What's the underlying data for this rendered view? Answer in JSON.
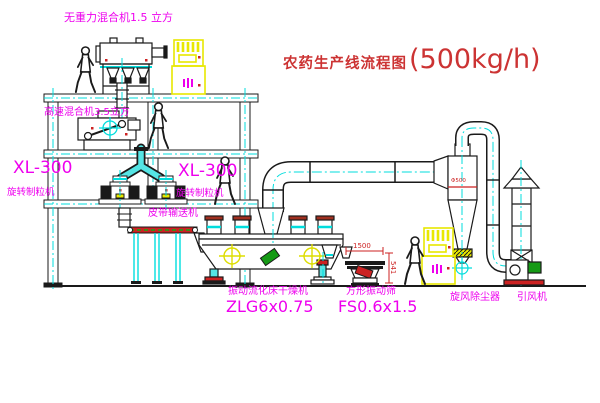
{
  "title": {
    "text": "农药生产线流程图",
    "capacity": "(500kg/h)"
  },
  "equipment": {
    "gravity_mixer": {
      "label": "无重力混合机1.5 立方"
    },
    "high_speed_mixer": {
      "label": "高速混合机3.5立方"
    },
    "granulator_left": {
      "model": "XL-300",
      "label": "旋转制粒机"
    },
    "granulator_right": {
      "model": "XL-300",
      "label": "旋转制粒机"
    },
    "belt_conveyor": {
      "label": "皮带输送机"
    },
    "fluid_bed_dryer": {
      "label": "振动流化床干燥机",
      "model": "ZLG6x0.75"
    },
    "square_sieve": {
      "label": "方形振动筛",
      "model": "FS0.6x1.5"
    },
    "cyclone": {
      "label": "旋风除尘器"
    },
    "draft_fan": {
      "label": "引风机"
    }
  },
  "dimensions": {
    "sieve_length": "1500",
    "sieve_outlet_height": "541",
    "cyclone_dia": "Φ500"
  },
  "colors": {
    "label_magenta": "#ee00ee",
    "title_red": "#cc3333",
    "centerline_cyan": "#00dddd",
    "dimension_red": "#cc2222",
    "cabinet_yellow": "#e8e800",
    "motor_green": "#159a15"
  }
}
